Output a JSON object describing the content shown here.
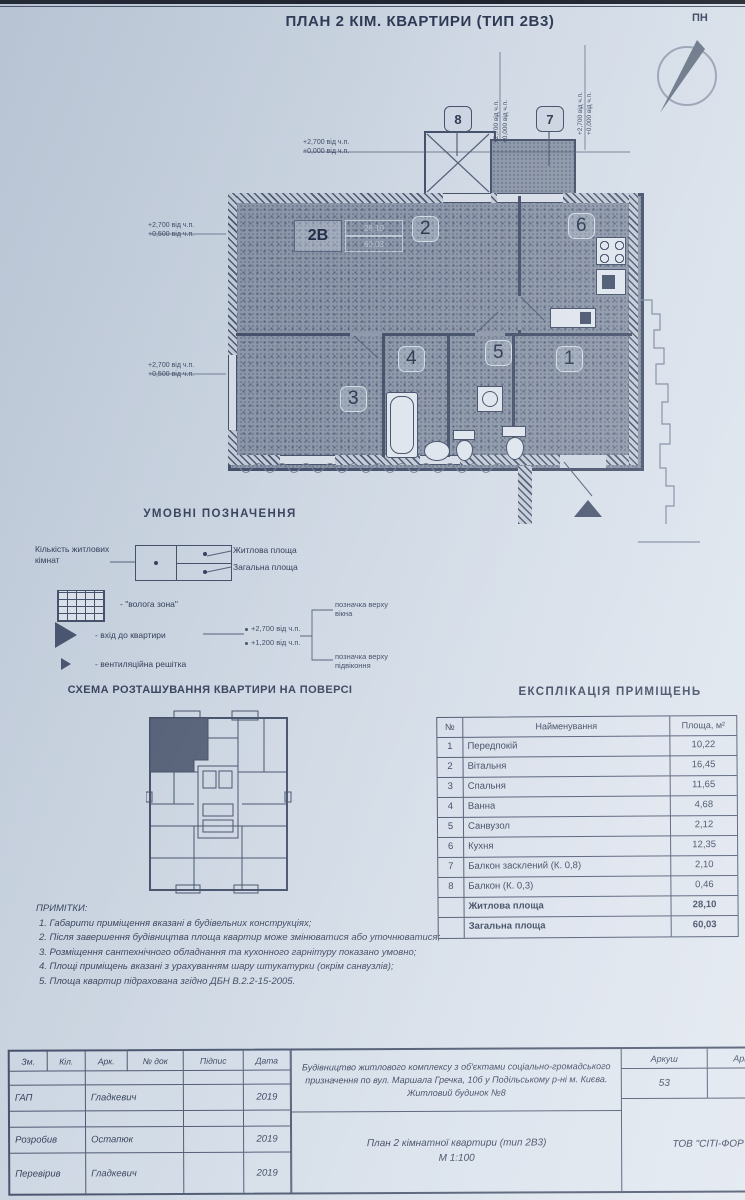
{
  "doc": {
    "title": "ПЛАН 2 КІМ. КВАРТИРИ (ТИП 2В3)"
  },
  "compass": {
    "label": "ПН"
  },
  "plan": {
    "type_label": "2В",
    "living_value": "28,10",
    "total_value": "60,03",
    "rooms": {
      "r1": "1",
      "r2": "2",
      "r3": "3",
      "r4": "4",
      "r5": "5",
      "r6": "6"
    },
    "balcony8_label": "8",
    "balcony7_label": "7",
    "elev_top_1": "+2,700 від ч.п.",
    "elev_top_2": "+0,000 від ч.п.",
    "elev_left_1": "+2,700 від ч.п.",
    "elev_left_2": "+0,500 від ч.п.",
    "elev_right_1": "+2,700 від ч.п.",
    "elev_right_2": "+0,000 від ч.п."
  },
  "legend": {
    "title": "УМОВНІ ПОЗНАЧЕННЯ",
    "rooms_count_label": "Кількість житлових кімнат",
    "living_area_label": "Житлова площа",
    "total_area_label": "Загальна площа",
    "wet_zone_label": "- \"волога зона\"",
    "entrance_label": "- вхід до квартири",
    "vent_label": "- вентиляційна решітка",
    "sample_top": "+2,700 від ч.п.",
    "sample_bottom": "+1,200 від ч.п.",
    "window_mark_label": "позначка верху вікна",
    "sill_mark_label": "позначка верху підвіконня"
  },
  "schema": {
    "title": "СХЕМА РОЗТАШУВАННЯ КВАРТИРИ НА ПОВЕРСІ"
  },
  "explication": {
    "title": "ЕКСПЛІКАЦІЯ ПРИМІЩЕНЬ",
    "headers": [
      "№",
      "Найменування",
      "Площа, м²"
    ],
    "rows": [
      [
        "1",
        "Передпокій",
        "10,22"
      ],
      [
        "2",
        "Вітальня",
        "16,45"
      ],
      [
        "3",
        "Спальня",
        "11,65"
      ],
      [
        "4",
        "Ванна",
        "4,68"
      ],
      [
        "5",
        "Санвузол",
        "2,12"
      ],
      [
        "6",
        "Кухня",
        "12,35"
      ],
      [
        "7",
        "Балкон засклений (К. 0,8)",
        "2,10"
      ],
      [
        "8",
        "Балкон (К. 0,3)",
        "0,46"
      ]
    ],
    "totals": [
      [
        "Житлова площа",
        "28,10"
      ],
      [
        "Загальна площа",
        "60,03"
      ]
    ]
  },
  "notes": {
    "title": "ПРИМІТКИ:",
    "items": [
      "1. Габарити приміщення вказані в будівельних конструкціях;",
      "2. Після завершення будівництва площа квартир може змінюватися або уточнюватися;",
      "3. Розміщення сантехнічного обладнання та кухонного гарнітуру показано умовно;",
      "4. Площі приміщень вказані з урахуванням шару штукатурки (окрім санвузлів);",
      "5. Площа квартир підрахована згідно ДБН В.2.2-15-2005."
    ]
  },
  "titleblock": {
    "headers": [
      "Зм.",
      "Кіл.",
      "Арк.",
      "№ док",
      "Підпис",
      "Дата"
    ],
    "rows": [
      {
        "role": "ГАП",
        "name": "Гладкевич",
        "date": "2019"
      },
      {
        "role": "",
        "name": "",
        "date": ""
      },
      {
        "role": "Розробив",
        "name": "Остапюк",
        "date": "2019"
      },
      {
        "role": "Перевірив",
        "name": "Гладкевич",
        "date": "2019"
      }
    ],
    "project": "Будівництво житлового комплексу з об'єктами соціально-громадського призначення по вул. Маршала Гречка, 10б у Подільському р-ні м. Києва. Житловий будинок №8",
    "drawing_title": "План 2 кімнатної квартири (тип 2В3)",
    "scale": "М 1:100",
    "sheet_label": "Аркуш",
    "sheets_label": "Аркушів",
    "sheet_number": "53",
    "company": "ТОВ \"СІТІ-ФОР"
  }
}
